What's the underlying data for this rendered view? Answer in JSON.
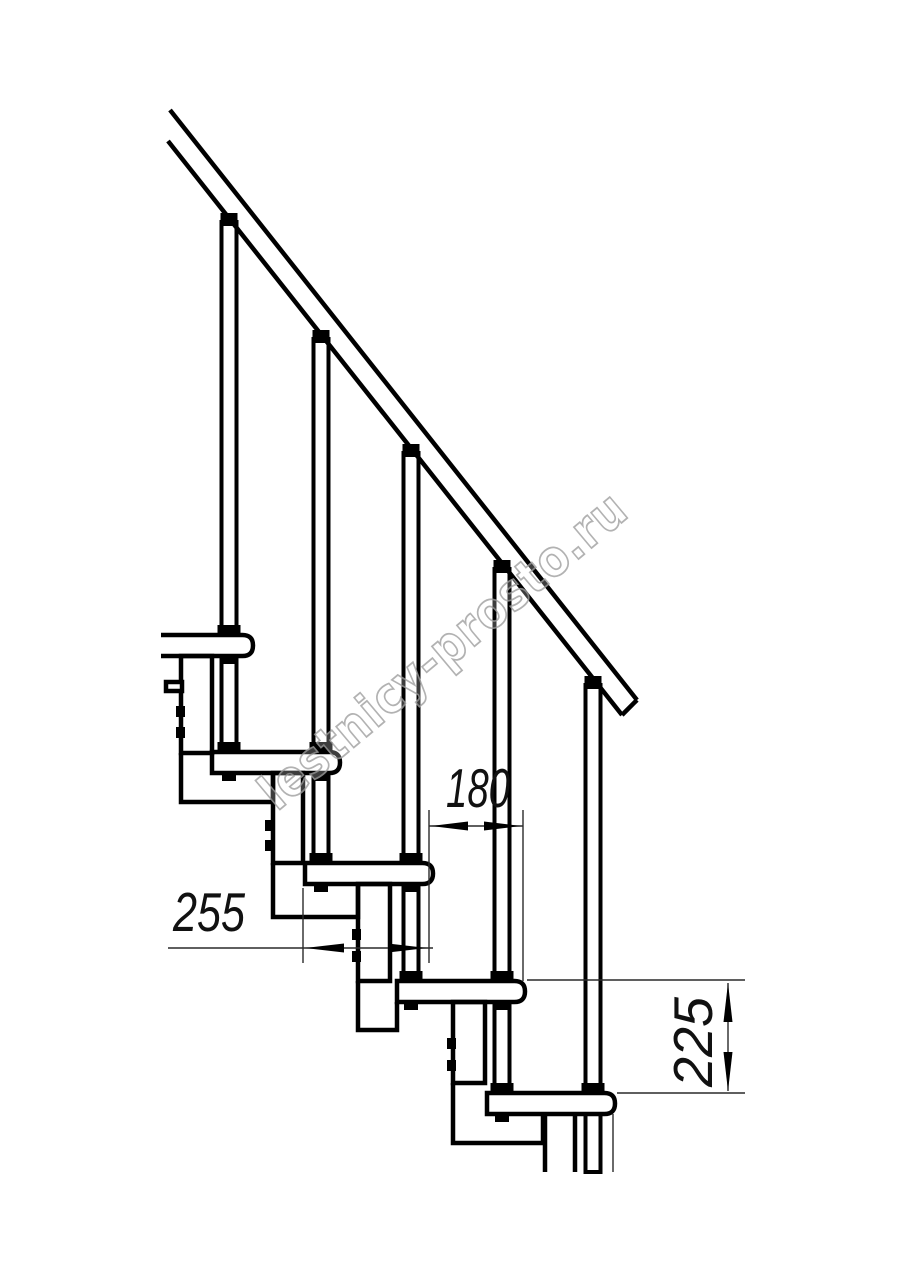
{
  "drawing": {
    "kind": "staircase-technical-side-view",
    "watermark_text": "lestnicy-prosto.ru",
    "colors": {
      "line": "#000000",
      "dimension_text": "#111111",
      "watermark": "#a0a0a0",
      "background": "#ffffff"
    },
    "dimensions": [
      {
        "id": "step-depth",
        "label": "255",
        "orientation": "horizontal"
      },
      {
        "id": "step-going",
        "label": "180",
        "orientation": "horizontal"
      },
      {
        "id": "step-rise",
        "label": "225",
        "orientation": "vertical"
      }
    ]
  }
}
